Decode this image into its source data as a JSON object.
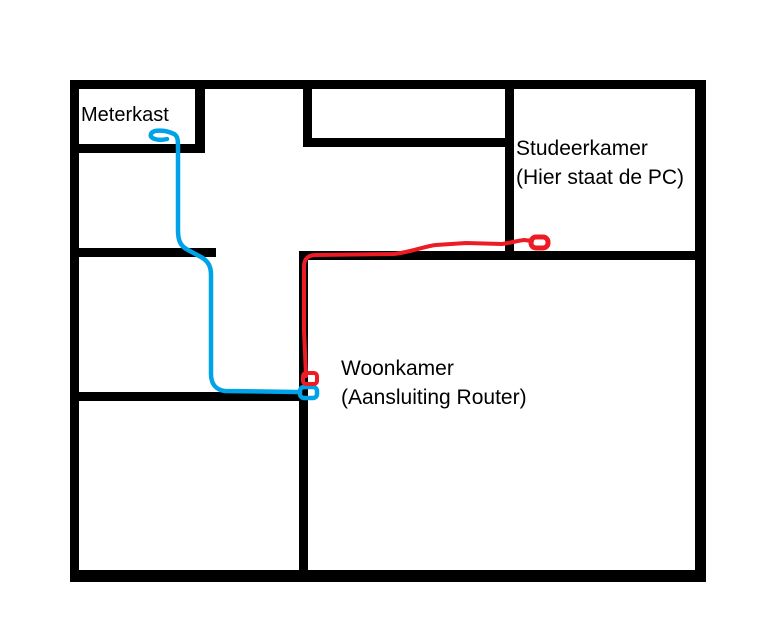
{
  "title": "Hand-drawn floor plan with network cable routes",
  "colors": {
    "background": "#FFFFFF",
    "wall": "#000000",
    "text": "#000000",
    "blue_cable": "#00A2E8",
    "red_cable": "#ED1C24"
  },
  "labels": {
    "meterkast": {
      "line1": "Meterkast"
    },
    "studeerkamer": {
      "line1": "Studeerkamer",
      "line2": "(Hier staat de PC)"
    },
    "woonkamer": {
      "line1": "Woonkamer",
      "line2": "(Aansluiting Router)"
    }
  },
  "floorplan": {
    "canvas": {
      "width": 777,
      "height": 630
    },
    "walls": [
      {
        "name": "outer-top-wall",
        "x": 70,
        "y": 80,
        "w": 636,
        "h": 9
      },
      {
        "name": "outer-left-wall",
        "x": 70,
        "y": 80,
        "w": 9,
        "h": 502
      },
      {
        "name": "outer-right-wall",
        "x": 695,
        "y": 80,
        "w": 11,
        "h": 502
      },
      {
        "name": "outer-bottom-wall",
        "x": 70,
        "y": 570,
        "w": 636,
        "h": 12
      },
      {
        "name": "meterkast-bottom-wall",
        "x": 70,
        "y": 144,
        "w": 135,
        "h": 9
      },
      {
        "name": "meterkast-right-wall",
        "x": 195,
        "y": 80,
        "w": 10,
        "h": 73
      },
      {
        "name": "left-hall-upper-wall",
        "x": 70,
        "y": 248,
        "w": 146,
        "h": 9
      },
      {
        "name": "left-hall-lower-wall",
        "x": 70,
        "y": 392,
        "w": 238,
        "h": 9
      },
      {
        "name": "center-vertical-wall",
        "x": 299,
        "y": 251,
        "w": 9,
        "h": 331
      },
      {
        "name": "woonkamer-top-wall",
        "x": 299,
        "y": 251,
        "w": 407,
        "h": 9
      },
      {
        "name": "midtop-room-left-wall",
        "x": 303,
        "y": 86,
        "w": 9,
        "h": 58
      },
      {
        "name": "midtop-room-bottom-wall",
        "x": 303,
        "y": 138,
        "w": 211,
        "h": 9
      },
      {
        "name": "studeerkamer-left-wall",
        "x": 505,
        "y": 86,
        "w": 9,
        "h": 170
      }
    ],
    "cables": [
      {
        "name": "blue-cable-meterkast-to-router",
        "connects": "Meterkast -> Woonkamer (Aansluiting Router)",
        "color_key": "blue_cable",
        "stroke_width": 4.5,
        "paths": [
          "M 174 134 C 166 130 153 129 151 134 C 149 139 159 141 167 139",
          "M 174 134 C 178 136 178 141 178 148 L 178 230 C 178 240 180 246 188 250 L 201 257 C 208 261 211 266 211 275 L 211 374 C 211 384 216 390 225 391 L 298 392"
        ],
        "markers": [
          {
            "name": "blue-cable-router-end",
            "x": 300,
            "y": 387,
            "w": 17,
            "h": 11,
            "rx": 4,
            "sw": 4.5
          }
        ]
      },
      {
        "name": "red-cable-router-to-pc",
        "connects": "Woonkamer (Aansluiting Router) -> Studeerkamer (PC)",
        "color_key": "red_cable",
        "stroke_width": 4,
        "paths": [
          "M 306 376 L 304 330 L 304 266 C 304 258 309 255 316 255 L 394 254 C 412 252 425 246 436 245 L 466 243 L 502 244 C 510 243 516 241 524 240 L 532 241"
        ],
        "markers": [
          {
            "name": "red-cable-router-end",
            "x": 303,
            "y": 373,
            "w": 14,
            "h": 11,
            "rx": 3,
            "sw": 4
          },
          {
            "name": "red-cable-pc-end",
            "x": 531,
            "y": 237,
            "w": 17,
            "h": 11,
            "rx": 5,
            "sw": 5
          }
        ]
      }
    ]
  }
}
